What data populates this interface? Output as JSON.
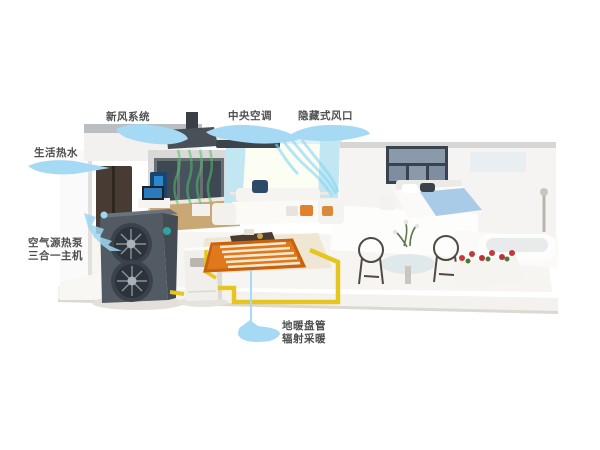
{
  "callouts": {
    "fresh_air": {
      "label": "新风系统"
    },
    "hot_water": {
      "label": "生活热水"
    },
    "central_ac": {
      "label": "中央空调"
    },
    "air_outlet": {
      "label": "隐藏式风口"
    },
    "heat_pump": {
      "line1": "空气源热泵",
      "line2": "三合一主机"
    },
    "floor_heating": {
      "line1": "地暖盘管",
      "line2": "辐射采暖"
    }
  },
  "colors": {
    "callout_blob": "#a6daf4",
    "label_text": "#4f4f4f",
    "pipe_yellow": "#e7c520",
    "floor_heating_orange": "#e0791b",
    "fresh_air_green": "#52c06c",
    "cool_air_blue": "#86d6f2",
    "heat_pump_body": "#525a63",
    "pillow_orange": "#e0812e",
    "bed_blue": "#a9cbe8",
    "flower_red": "#c43a3c"
  }
}
